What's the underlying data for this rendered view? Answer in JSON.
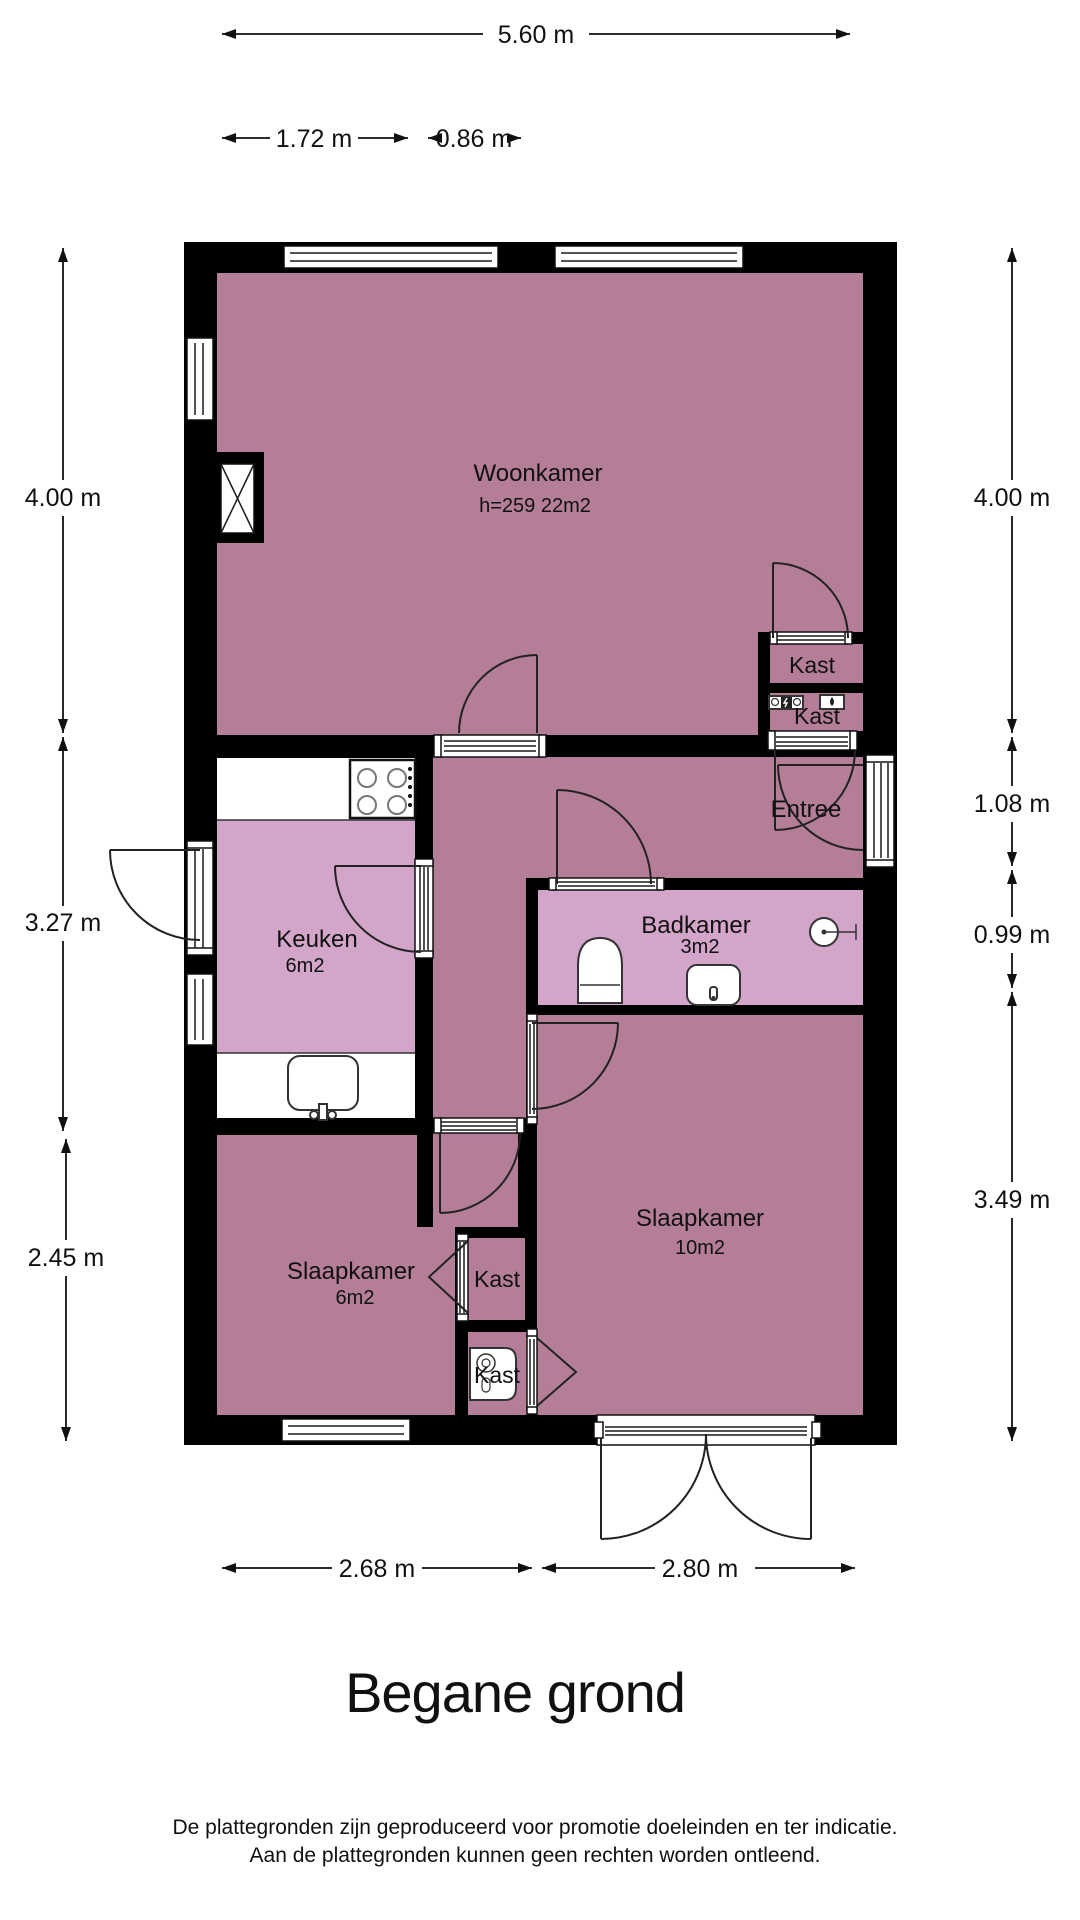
{
  "title": "Begane grond",
  "footer": {
    "line1": "De plattegronden zijn geproduceerd voor promotie doeleinden en ter indicatie.",
    "line2": "Aan de plattegronden kunnen geen rechten worden ontleend."
  },
  "dimensions": {
    "top_total": "5.60 m",
    "top_left": "1.72 m",
    "top_right": "0.86 m",
    "left": [
      "4.00 m",
      "3.27 m",
      "2.45 m"
    ],
    "right": [
      "4.00 m",
      "1.08 m",
      "0.99 m",
      "3.49 m"
    ],
    "bottom": [
      "2.68 m",
      "2.80 m"
    ]
  },
  "rooms": {
    "woonkamer": {
      "name": "Woonkamer",
      "details": "h=259  22m2"
    },
    "keuken": {
      "name": "Keuken",
      "area": "6m2"
    },
    "badkamer": {
      "name": "Badkamer",
      "area": "3m2"
    },
    "entree": {
      "name": "Entree"
    },
    "kast_boven": {
      "name": "Kast"
    },
    "kast_meter": {
      "name": "Kast"
    },
    "kast_midden": {
      "name": "Kast"
    },
    "kast_onder": {
      "name": "Kast"
    },
    "slaapkamer_links": {
      "name": "Slaapkamer",
      "area": "6m2"
    },
    "slaapkamer_rechts": {
      "name": "Slaapkamer",
      "area": "10m2"
    }
  },
  "colors": {
    "wall": "#000000",
    "room_dark": "#b47e98",
    "room_light": "#d2a5c9",
    "counter": "#ffffff"
  }
}
